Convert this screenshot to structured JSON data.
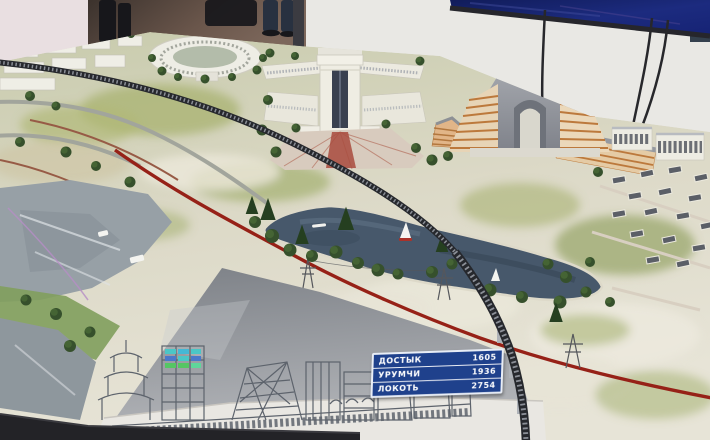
{
  "distance_sign": {
    "rows": [
      {
        "label": "ДОСТЫК",
        "value": "1605"
      },
      {
        "label": "УРУМЧИ",
        "value": "1936"
      },
      {
        "label": "ЛОКОТЬ",
        "value": "2754"
      }
    ]
  },
  "colors": {
    "sign_background": "#1f418c",
    "screen_blue": "#18246f",
    "border_line_red": "#9c1f15",
    "lake_water": "#46586c",
    "terrain_green": "#a8b26e",
    "model_base_gray": "#8f9299"
  }
}
